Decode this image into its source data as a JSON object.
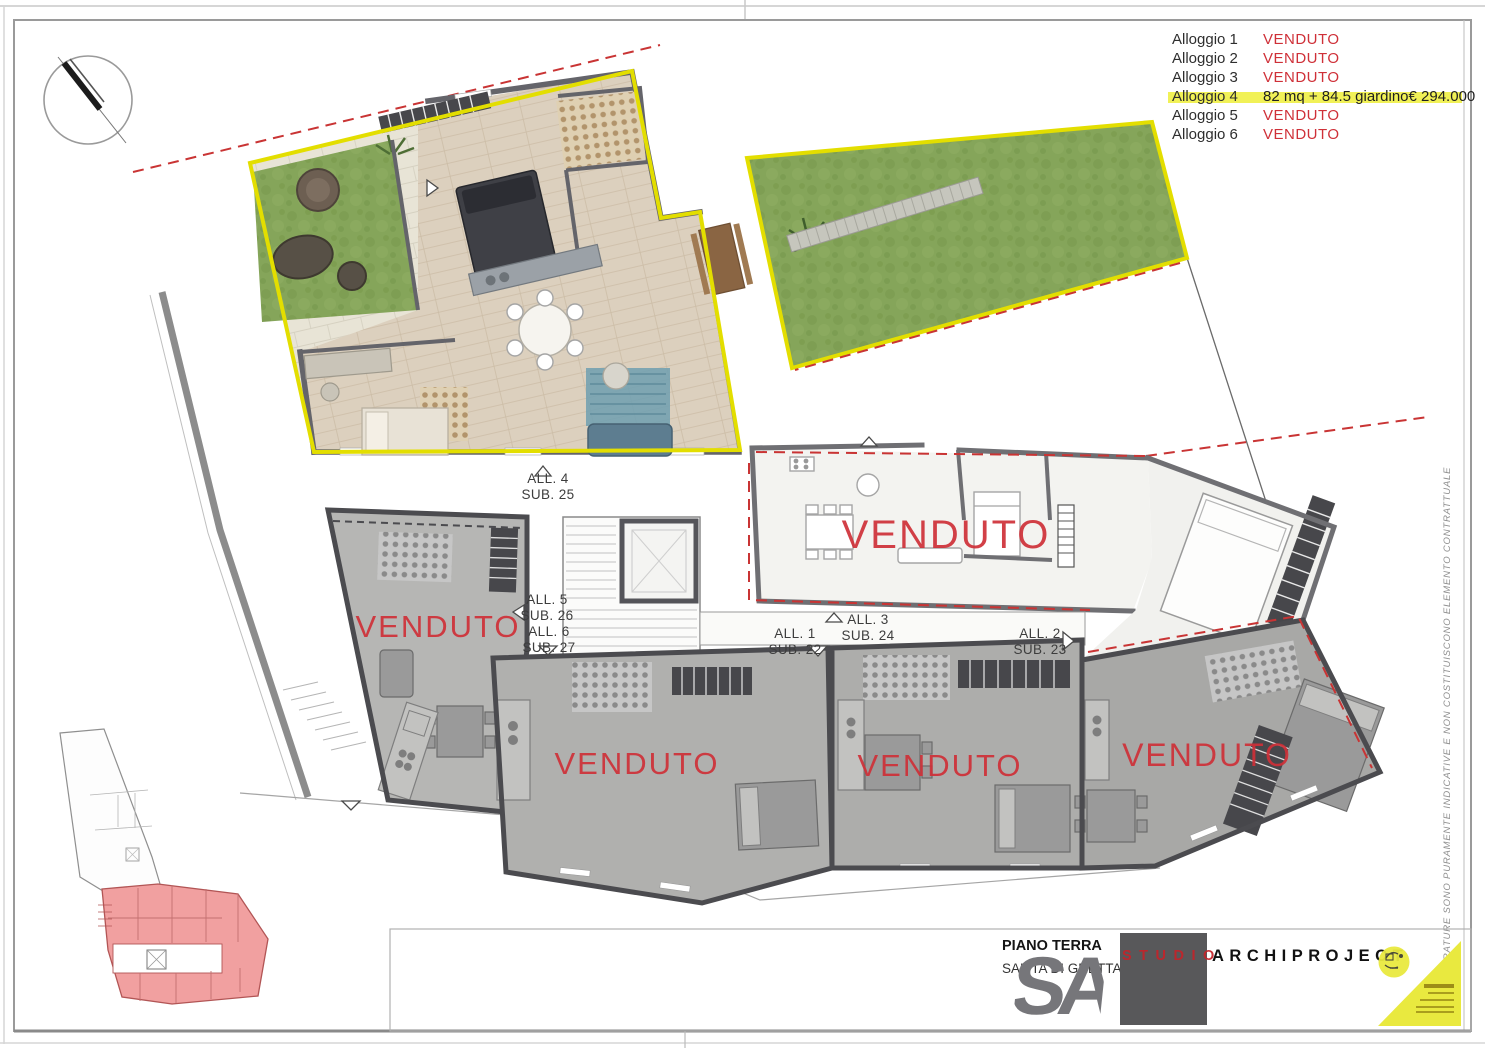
{
  "legend": {
    "rows": [
      {
        "label": "Alloggio 1",
        "value": "VENDUTO",
        "sold": true
      },
      {
        "label": "Alloggio 2",
        "value": "VENDUTO",
        "sold": true
      },
      {
        "label": "Alloggio 3",
        "value": "VENDUTO",
        "sold": true
      },
      {
        "label": "Alloggio 4",
        "value": "82 mq + 84.5 giardino€ 294.000",
        "sold": false,
        "highlighted": true
      },
      {
        "label": "Alloggio 5",
        "value": "VENDUTO",
        "sold": true
      },
      {
        "label": "Alloggio 6",
        "value": "VENDUTO",
        "sold": true
      }
    ],
    "highlight_color": "#eff045"
  },
  "plan": {
    "stamps": [
      {
        "text": "VENDUTO"
      },
      {
        "text": "VENDUTO"
      },
      {
        "text": "VENDUTO"
      },
      {
        "text": "VENDUTO"
      },
      {
        "text": "VENDUTO"
      }
    ],
    "unit_labels": [
      {
        "line1": "ALL. 4",
        "line2": "SUB. 25"
      },
      {
        "line1": "ALL. 5",
        "line2": "SUB. 26"
      },
      {
        "line1": "ALL. 6",
        "line2": "SUB. 27"
      },
      {
        "line1": "ALL. 1",
        "line2": "SUB. 22"
      },
      {
        "line1": "ALL. 3",
        "line2": "SUB. 24"
      },
      {
        "line1": "ALL. 2",
        "line2": "SUB. 23"
      }
    ],
    "disclaimer": "LE METRATURE SONO PURAMENTE INDICATIVE E NON COSTITUISCONO ELEMENTO CONTRATTUALE"
  },
  "title_block": {
    "floor_label": "PIANO TERRA",
    "address": "SALITA DI GRETTA 15",
    "logo_studio": "STUDIO",
    "logo_brand": "ARCHIPROJECT",
    "logo_monogram": "SA"
  },
  "colors": {
    "venduto_red": "#cf3038",
    "boundary_yellow": "#e3de00",
    "grass_green": "#85a55a",
    "keyplan_pink": "#f1a0a0",
    "wall_gray": "#4b4b4f"
  }
}
